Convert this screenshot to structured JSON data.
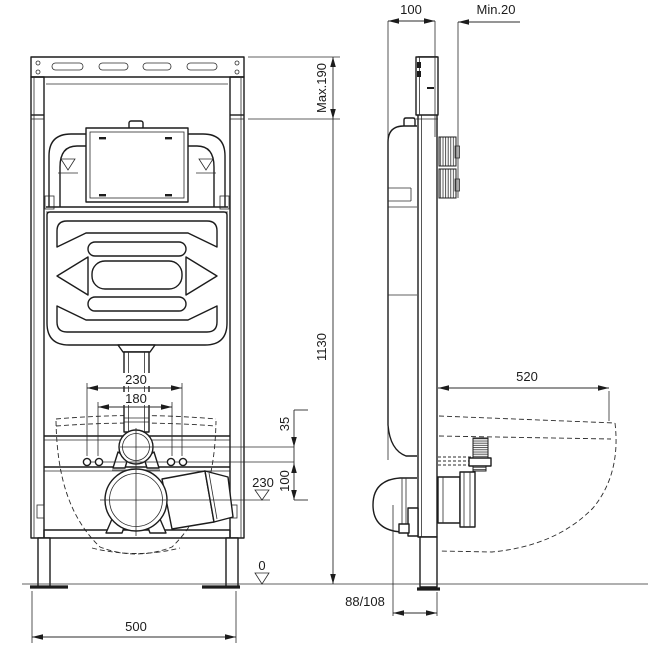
{
  "labels": {
    "front": {
      "width": "500",
      "height": "1130",
      "top_adjust": "Max.190",
      "bolt_span_outer": "230",
      "bolt_span_inner": "180",
      "flush_offset": "35",
      "outlet_offset": "100",
      "outlet_level": "230",
      "floor": "0"
    },
    "side": {
      "depth": "100",
      "wall_clearance": "Min.20",
      "projection": "520",
      "outlet_distance": "88/108"
    }
  },
  "colors": {
    "line": "#1c1c1c",
    "background": "#ffffff"
  }
}
